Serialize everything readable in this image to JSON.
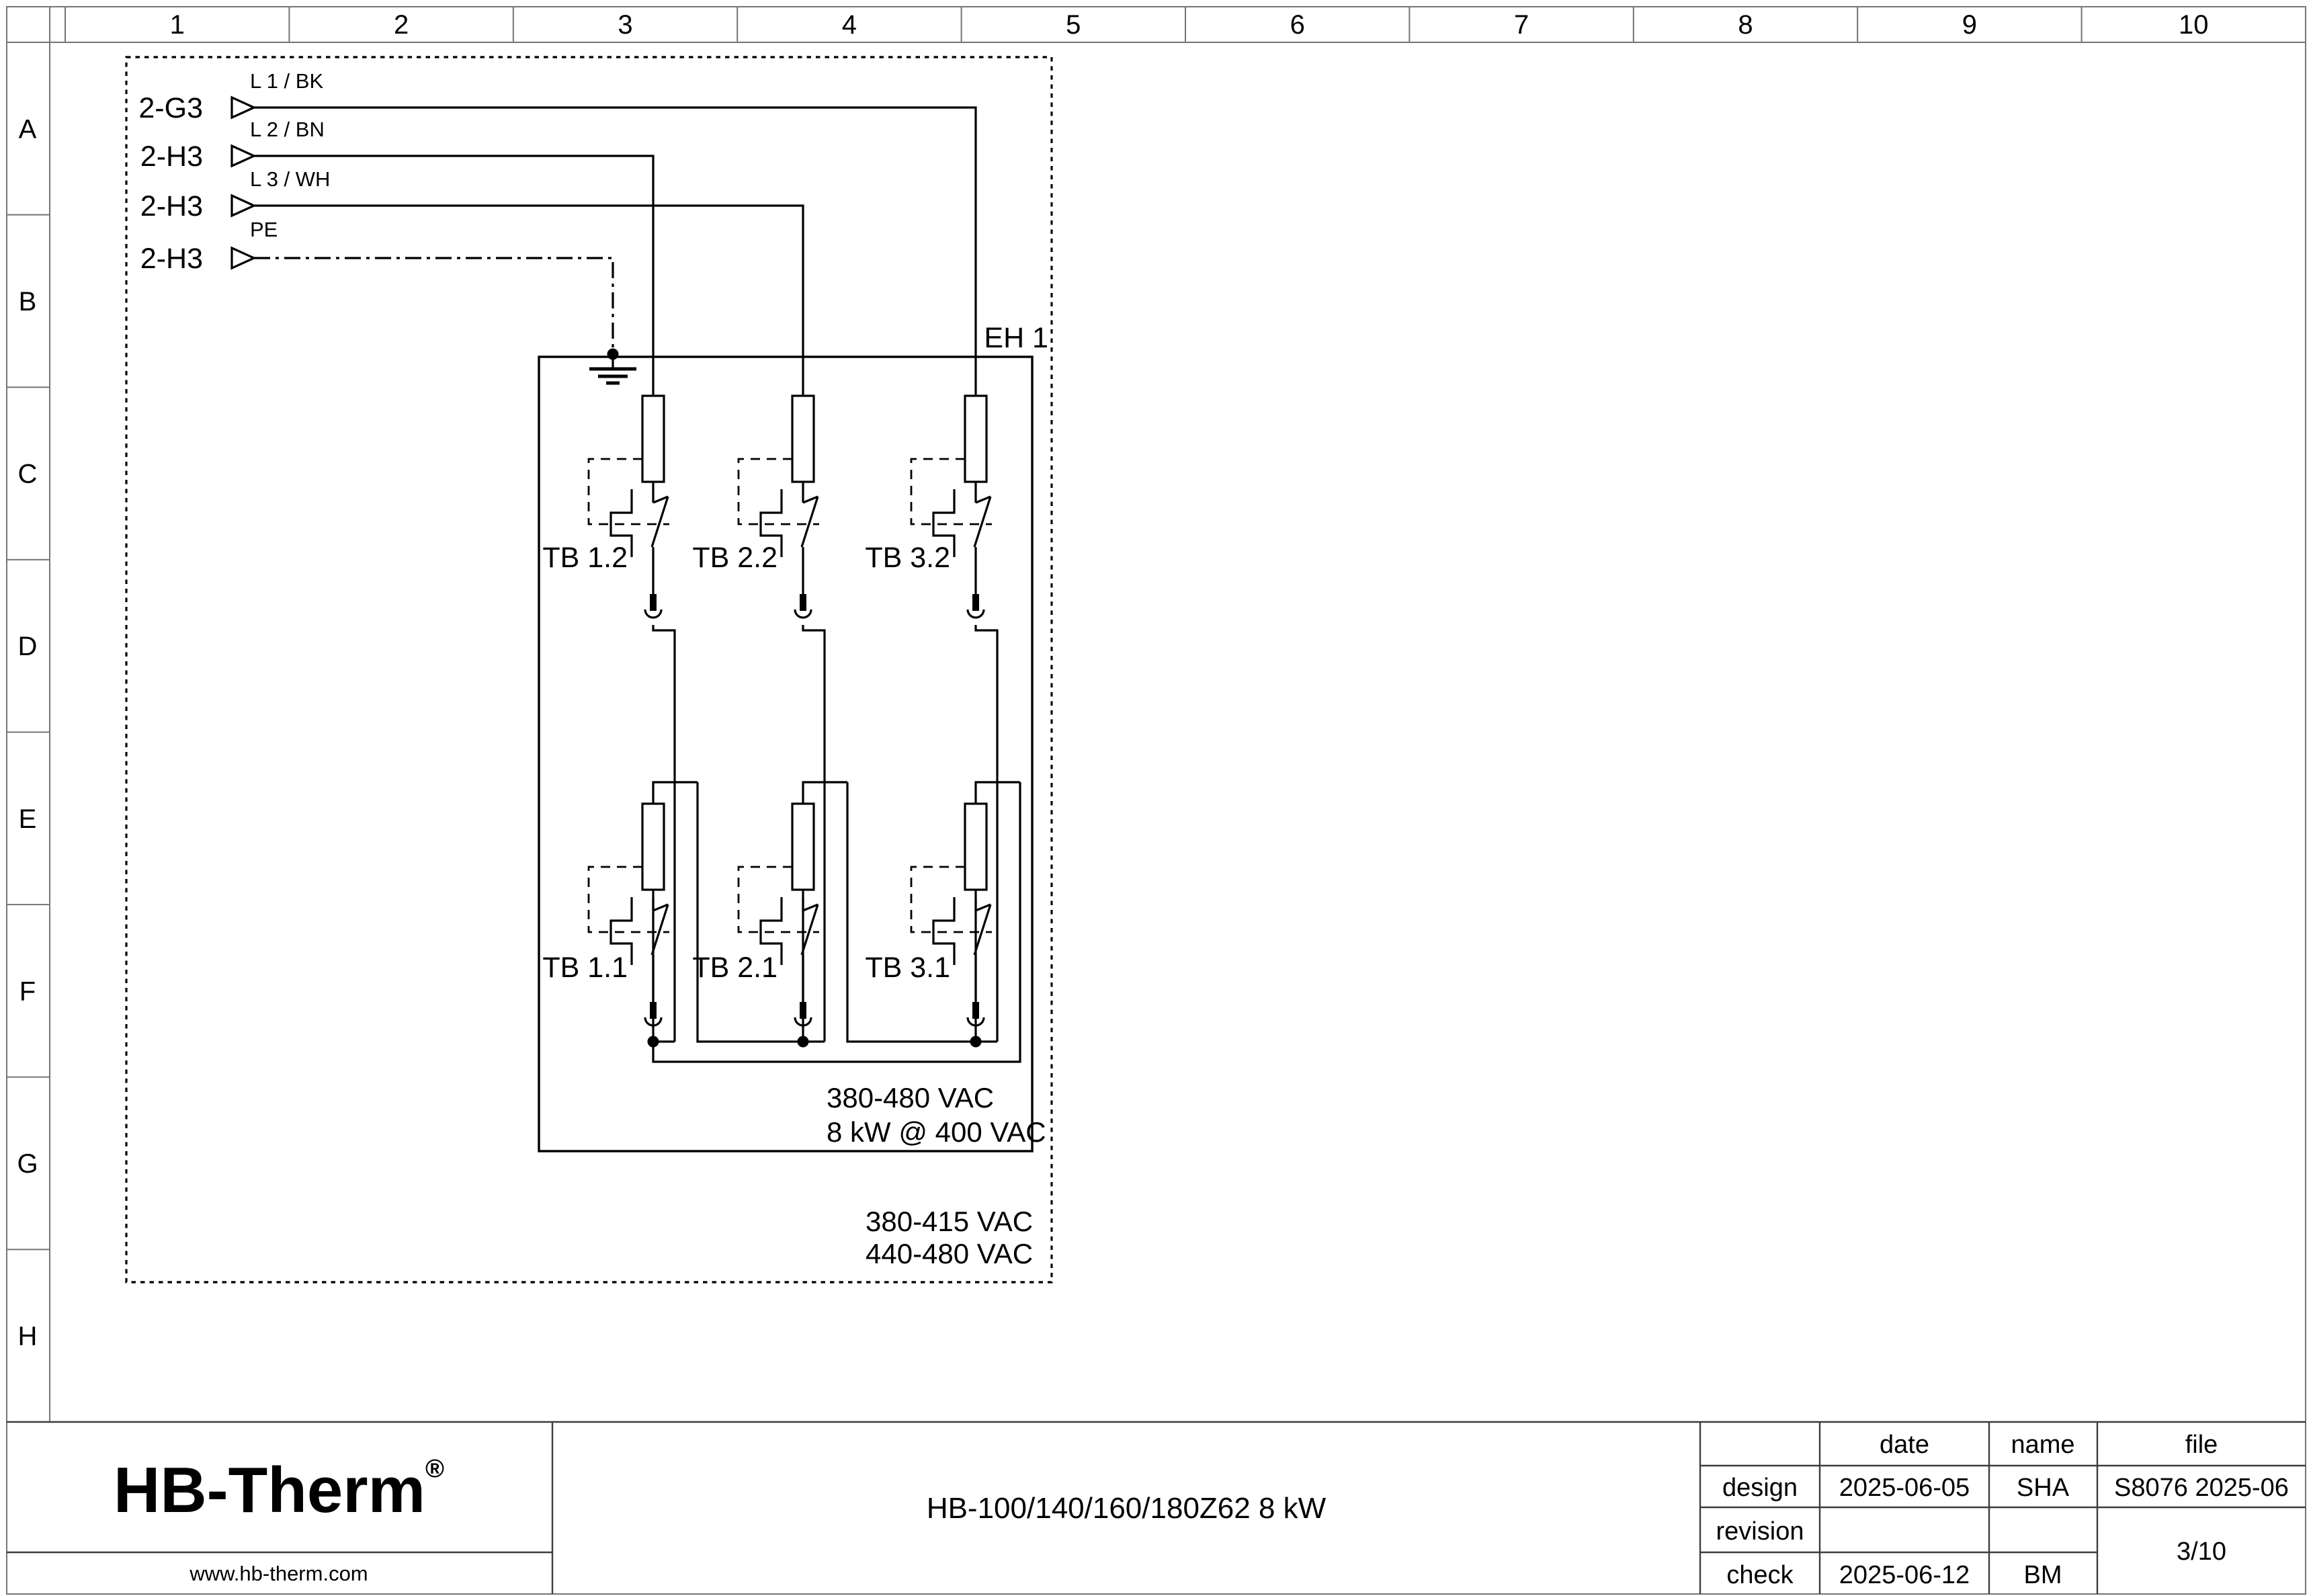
{
  "sheet": {
    "columns": [
      "1",
      "2",
      "3",
      "4",
      "5",
      "6",
      "7",
      "8",
      "9",
      "10"
    ],
    "rows": [
      "A",
      "B",
      "C",
      "D",
      "E",
      "F",
      "G",
      "H"
    ]
  },
  "schematic": {
    "sources": [
      {
        "tag": "2-G3",
        "wire_label": "L 1 / BK"
      },
      {
        "tag": "2-H3",
        "wire_label": "L 2 / BN"
      },
      {
        "tag": "2-H3",
        "wire_label": "L 3 / WH"
      },
      {
        "tag": "2-H3",
        "wire_label": "PE"
      }
    ],
    "enclosure_label": "EH 1",
    "tb_labels": [
      "TB 1.2",
      "TB 2.2",
      "TB 3.2",
      "TB 1.1",
      "TB 2.1",
      "TB 3.1"
    ],
    "ratings_inner": [
      "380-480 VAC",
      "8 kW @ 400 VAC"
    ],
    "ratings_outer": [
      "380-415 VAC",
      "440-480 VAC"
    ]
  },
  "title_block": {
    "logo_text": "HB-Therm",
    "logo_reg": "®",
    "logo_color": "#1a234f",
    "website": "www.hb-therm.com",
    "document_title": "HB-100/140/160/180Z62 8 kW",
    "table": {
      "headers": [
        "date",
        "name",
        "file"
      ],
      "rows": [
        {
          "label": "design",
          "date": "2025-06-05",
          "name": "SHA",
          "file": "S8076 2025-06"
        },
        {
          "label": "revision",
          "date": "",
          "name": "",
          "file": ""
        },
        {
          "label": "check",
          "date": "2025-06-12",
          "name": "BM",
          "file": ""
        }
      ],
      "page": "3/10"
    }
  }
}
